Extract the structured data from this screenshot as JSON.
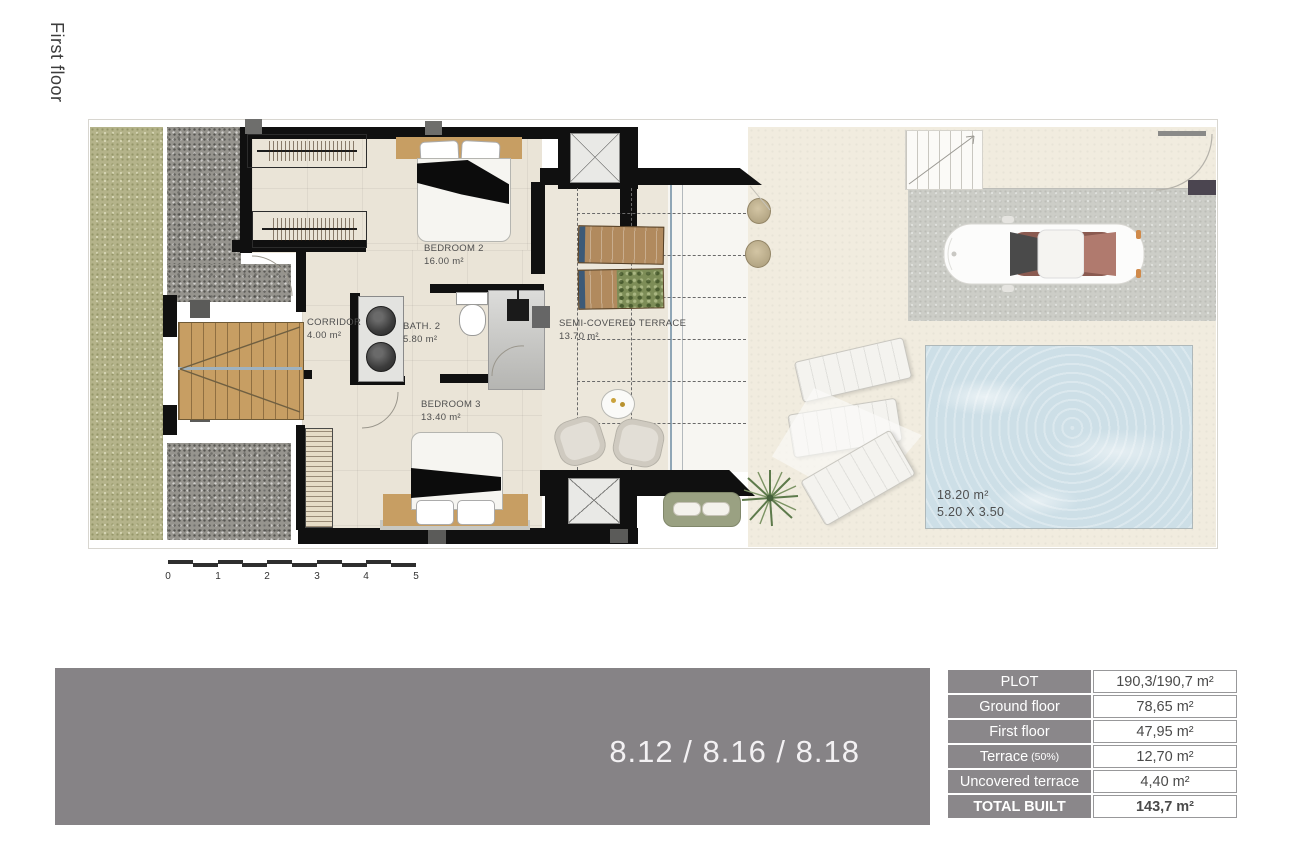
{
  "plan": {
    "floor_label": "First floor",
    "rooms": {
      "bedroom2": {
        "name": "BEDROOM 2",
        "area": "16.00 m²"
      },
      "corridor": {
        "name": "CORRIDOR",
        "area": "4.00 m²"
      },
      "bath2": {
        "name": "BATH. 2",
        "area": "5.80 m²"
      },
      "bedroom3": {
        "name": "BEDROOM 3",
        "area": "13.40 m²"
      },
      "semi_covered_terrace": {
        "name": "SEMI-COVERED TERRACE",
        "area": "13.70 m²"
      }
    },
    "pool": {
      "area": "18.20 m²",
      "dimensions": "5.20 X 3.50"
    },
    "scale_ticks": [
      "0",
      "1",
      "2",
      "3",
      "4",
      "5"
    ]
  },
  "banner": {
    "units": "8.12 / 8.16 / 8.18",
    "background": "#868386"
  },
  "area_table": {
    "header_background": "#8a878a",
    "rows": [
      {
        "label": "PLOT",
        "value": "190,3/190,7 m²"
      },
      {
        "label": "Ground floor",
        "value": "78,65 m²"
      },
      {
        "label": "First floor",
        "value": "47,95 m²"
      },
      {
        "label": "Terrace",
        "note": "(50%)",
        "value": "12,70 m²"
      },
      {
        "label": "Uncovered terrace",
        "value": "4,40 m²"
      },
      {
        "label": "TOTAL BUILT",
        "value": "143,7 m²"
      }
    ]
  },
  "colors": {
    "pool_water": "#cddfe7",
    "grass": "#b4b38a",
    "wood": "#c79e63",
    "wall": "#101010"
  }
}
